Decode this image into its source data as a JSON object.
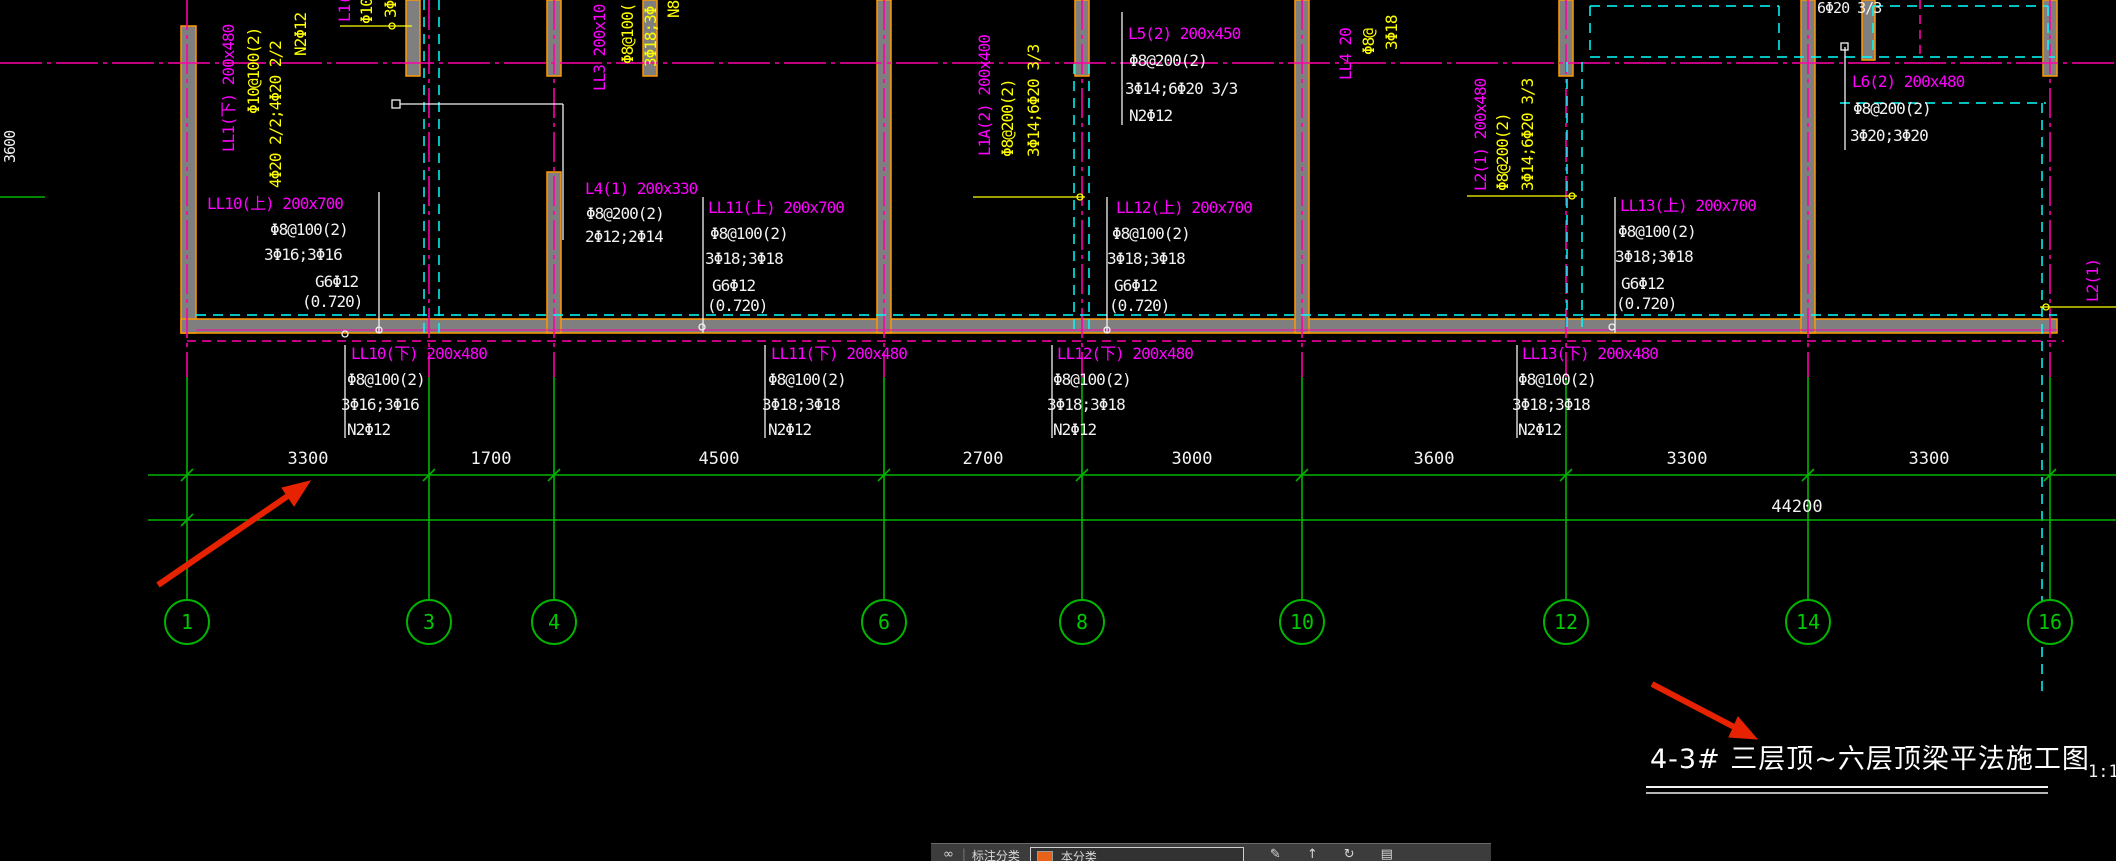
{
  "drawing": {
    "title": "4-3# 三层顶~六层顶梁平法施工图",
    "scale": "1:10",
    "top_right_note": "6Φ20 3/3",
    "left_vertical_dim": "3600"
  },
  "beams_upper": {
    "ll10": {
      "name": "LL10(上) 200x700",
      "stirrup": "Φ8@100(2)",
      "bars": "3Φ16;3Φ16",
      "side": "G6Φ12",
      "elev": "(0.720)"
    },
    "ll11": {
      "name": "LL11(上) 200x700",
      "stirrup": "Φ8@100(2)",
      "bars": "3Φ18;3Φ18",
      "side": "G6Φ12",
      "elev": "(0.720)"
    },
    "ll12": {
      "name": "LL12(上) 200x700",
      "stirrup": "Φ8@100(2)",
      "bars": "3Φ18;3Φ18",
      "side": "G6Φ12",
      "elev": "(0.720)"
    },
    "ll13": {
      "name": "LL13(上) 200x700",
      "stirrup": "Φ8@100(2)",
      "bars": "3Φ18;3Φ18",
      "side": "G6Φ12",
      "elev": "(0.720)"
    },
    "l4": {
      "name": "L4(1) 200x330",
      "stirrup": "Φ8@200(2)",
      "bars": "2Φ12;2Φ14"
    },
    "l5": {
      "name": "L5(2) 200x450",
      "stirrup": "Φ8@200(2)",
      "bars": "3Φ14;6Φ20 3/3",
      "side": "N2Φ12"
    },
    "l6": {
      "name": "L6(2) 200x480",
      "stirrup": "Φ8@200(2)",
      "bars": "3Φ20;3Φ20"
    }
  },
  "beams_lower": {
    "ll10": {
      "name": "LL10(下) 200x480",
      "stirrup": "Φ8@100(2)",
      "bars": "3Φ16;3Φ16",
      "side": "N2Φ12"
    },
    "ll11": {
      "name": "LL11(下) 200x480",
      "stirrup": "Φ8@100(2)",
      "bars": "3Φ18;3Φ18",
      "side": "N2Φ12"
    },
    "ll12": {
      "name": "LL12(下) 200x480",
      "stirrup": "Φ8@100(2)",
      "bars": "3Φ18;3Φ18",
      "side": "N2Φ12"
    },
    "ll13": {
      "name": "LL13(下) 200x480",
      "stirrup": "Φ8@100(2)",
      "bars": "3Φ18;3Φ18",
      "side": "N2Φ12"
    }
  },
  "vertical_labels": {
    "ll1": {
      "name": "LL1(下) 200x480",
      "stirrup": "Φ10@100(2)",
      "bars": "4Φ20 2/2;4Φ20 2/2",
      "side": "N2Φ12"
    },
    "l1p": {
      "name": "L1(",
      "stirrup": "Φ10",
      "bars": "3Φ"
    },
    "ll3": {
      "name": "LL3 200x10",
      "stirrup": "Φ8@100(",
      "bars": "3Φ18;3Φ",
      "side": "N8"
    },
    "l1a": {
      "name": "L1A(2) 200x400",
      "stirrup": "Φ8@200(2)",
      "bars": "3Φ14;6Φ20 3/3"
    },
    "l2": {
      "name": "L2(1) 200x480",
      "stirrup": "Φ8@200(2)",
      "bars": "3Φ14;6Φ20 3/3"
    },
    "ll4": {
      "name": "LL4 20",
      "stirrup": "Φ8@",
      "bars": "3Φ18"
    },
    "l2r": {
      "name": "L2(1)"
    }
  },
  "dimensions": {
    "row1": [
      "3300",
      "1700",
      "4500",
      "2700",
      "3000",
      "3600",
      "3300",
      "3300"
    ],
    "total": "44200"
  },
  "grid_bubbles": [
    "1",
    "3",
    "4",
    "6",
    "8",
    "10",
    "12",
    "14",
    "16"
  ],
  "toolbar": {
    "logo_glyph": "∞",
    "separator": "|",
    "label_annotation": "标注分类",
    "label_category": "本分类",
    "icons": [
      {
        "name": "edit-pen-icon",
        "glyph": "✎"
      },
      {
        "name": "upload-arrow-icon",
        "glyph": "↑"
      },
      {
        "name": "refresh-icon",
        "glyph": "↻"
      },
      {
        "name": "printer-icon",
        "glyph": "▤"
      }
    ]
  },
  "colors": {
    "beam_label_magenta": "#ff00ff",
    "rebar_yellow": "#ffff00",
    "partition_cyan": "#00ffff",
    "grid_green": "#00b400",
    "annotation_white": "#f2f2f2",
    "wall_gray": "#7f7f7f",
    "wall_edge_orange": "#ff9900",
    "arrow_red": "#e62200",
    "toolbar_swatch_orange": "#e8621a"
  }
}
